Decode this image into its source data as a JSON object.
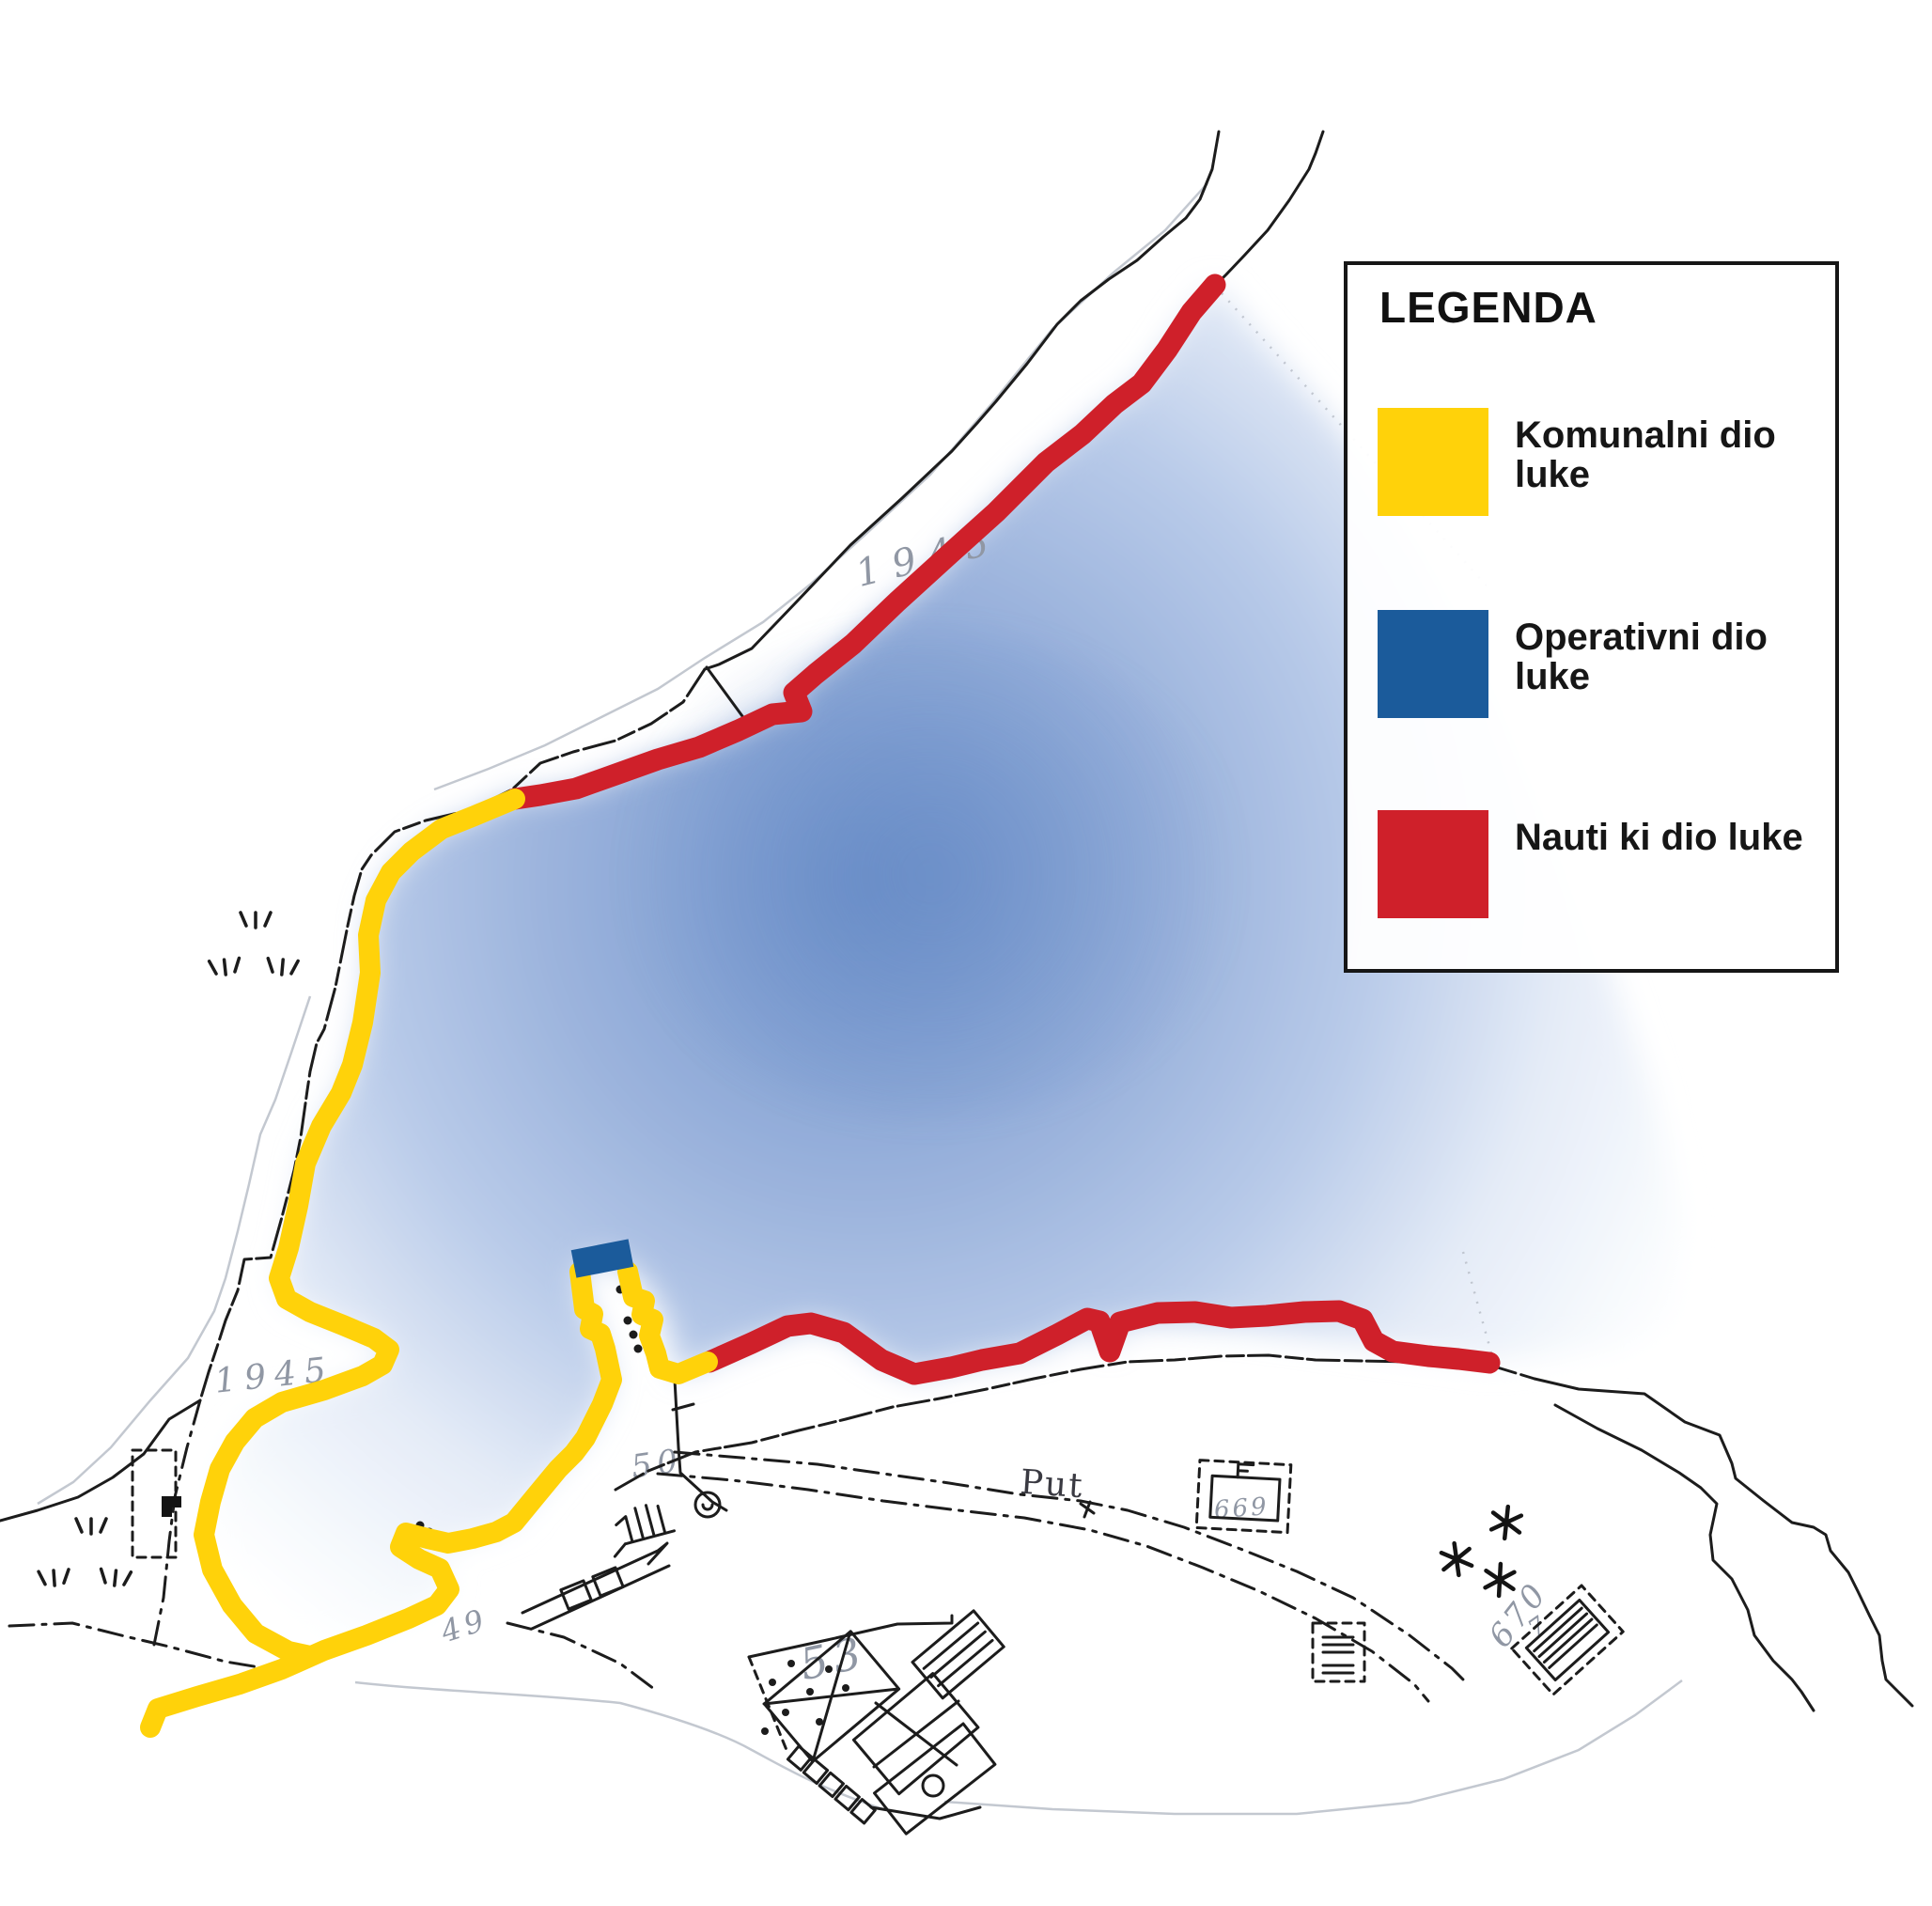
{
  "legend": {
    "title": "LEGENDA",
    "items": [
      {
        "label": "Komunalni dio luke",
        "color": "#FFD20A"
      },
      {
        "label": "Operativni dio luke",
        "color": "#1B5B9B"
      },
      {
        "label": "Nauti ki dio luke",
        "color": "#CF202A"
      }
    ]
  },
  "map_labels": {
    "year_upper": "1945",
    "year_lower": "1945",
    "road": "Put",
    "parcel_50": "50",
    "parcel_49": "49",
    "parcel_53": "53",
    "parcel_669": "669",
    "parcel_670": "670",
    "mark_7": "7"
  },
  "colors": {
    "komunalni_yellow": "#FFD20A",
    "operativni_blue": "#1B5B9B",
    "nauticki_red": "#CF202A",
    "sea_deep": "#7093CB",
    "sea_mid": "#B9CBE9",
    "sea_pale": "#E4EBF7",
    "ink": "#1C1C1C",
    "faint_line": "#B9BEC8",
    "faint_text": "#9097A4",
    "paper": "#FFFFFF"
  }
}
